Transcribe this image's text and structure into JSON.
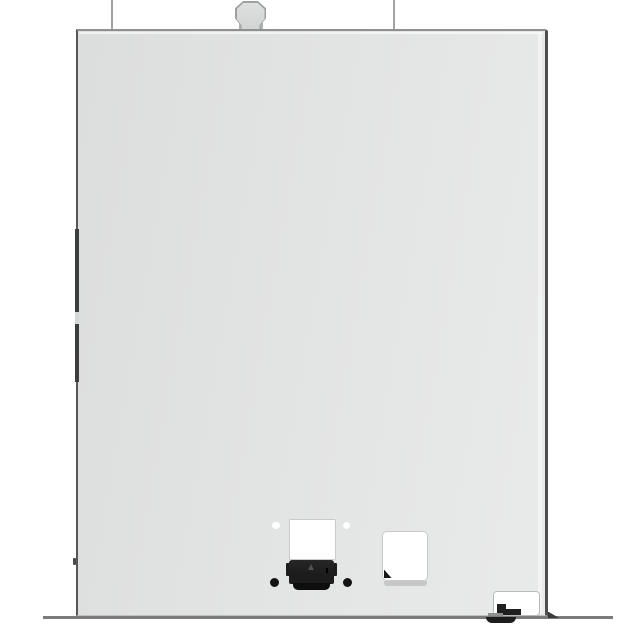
{
  "scene": {
    "subject": "appliance-rear-panel-product-photo",
    "text_content": []
  },
  "colors": {
    "background": "#ffffff",
    "panel_dark": "#dcdddd",
    "panel_mid": "#e2e3e3",
    "panel_light": "#e9eaea",
    "edge_top": "#8f9090",
    "edge_left": "#565757",
    "edge_right": "#4d4e4e",
    "seam_dark": "#3c3d3d",
    "guide_line": "#a2a2a2",
    "tab_fill": "#dedfdf",
    "tab_border": "#9fa0a0",
    "tab_base": "#b0b1b1",
    "cutout_white": "#ffffff",
    "cutout_border": "#c9cbcb",
    "connector": "#1c1c1c",
    "connector_lip": "#0e0e0e",
    "screw": "#131313",
    "baseline": "#7a7b7b"
  },
  "parts": [
    {
      "name": "mount-guide-line-left"
    },
    {
      "name": "mount-guide-line-right"
    },
    {
      "name": "hanger-tab"
    },
    {
      "name": "rear-panel"
    },
    {
      "name": "left-edge-seam"
    },
    {
      "name": "cord-exit-cutout"
    },
    {
      "name": "mounting-hole-left"
    },
    {
      "name": "mounting-hole-right"
    },
    {
      "name": "power-connector"
    },
    {
      "name": "screw-left"
    },
    {
      "name": "screw-right"
    },
    {
      "name": "vent-cutout"
    },
    {
      "name": "vent-corner-notch"
    },
    {
      "name": "corner-service-cutout"
    },
    {
      "name": "latch-step"
    },
    {
      "name": "base-line"
    },
    {
      "name": "leveling-foot"
    }
  ]
}
